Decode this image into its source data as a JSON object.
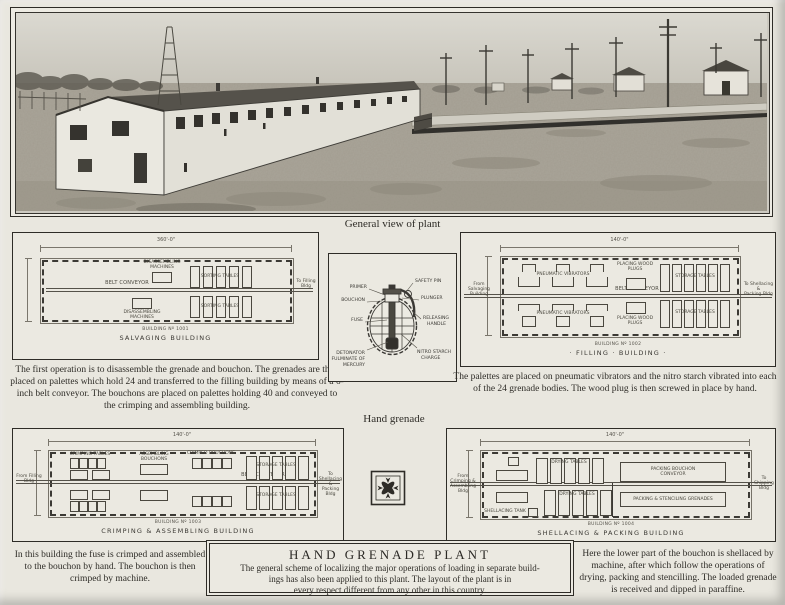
{
  "page": {
    "photo_caption": "General view of plant",
    "hand_grenade_label": "Hand grenade"
  },
  "captions": {
    "salvaging": "The first operation is to disassemble the grenade and bouchon.  The grenades are then placed on palettes which hold 24 and transferred to the filling building by means of a 6-inch belt conveyor.  The bouchons are placed on palettes holding 40 and conveyed to the crimping and assembling building.",
    "filling": "The palettes are placed on pneumatic vibrators and the nitro starch vibrated into each of the 24 grenade bodies.  The wood plug is then screwed in place by hand.",
    "crimping": "In this building the fuse is crimped and assembled to the bouchon by hand.  The bouchon is then crimped by machine.",
    "shellacing": "Here the lower part of the bouchon is shellaced by machine, after which follow the operations of drying, packing and stencilling.  The loaded grenade is received and dipped in paraffine."
  },
  "title_box": {
    "title": "HAND GRENADE PLANT",
    "line1": "The general scheme of localizing the major operations of loading in separate build-",
    "line2": "ings has also been applied to this plant.  The layout of the plant is in",
    "line3": "every respect different from any other in this country."
  },
  "grenade": {
    "primer": "PRIMER",
    "safety_pin": "SAFETY PIN",
    "bouchon": "BOUCHON",
    "plunger": "PLUNGER",
    "fuse": "FUSE",
    "releasing_l1": "RELEASING",
    "releasing_l2": "HANDLE",
    "detonator_l1": "DETONATOR",
    "detonator_l2": "FULMINATE OF",
    "detonator_l3": "MERCURY",
    "nitro_l1": "NITRO STARCH",
    "nitro_l2": "CHARGE"
  },
  "plans": {
    "salvaging": {
      "number": "BUILDING Nº 1001",
      "name": "SALVAGING BUILDING",
      "dim": "360'-0\"",
      "belt": "BELT CONVEYOR",
      "to_label": "To Filling Bldg",
      "machines_l1": "DISASSEMBLING",
      "machines_l2": "MACHINES",
      "tables": "SORTING TABLES"
    },
    "filling": {
      "number": "BUILDING Nº 1002",
      "name": "· FILLING · BUILDING ·",
      "dim": "140'-0\"",
      "belt": "BELT CONVEYOR",
      "from_l1": "From Salvaging",
      "from_l2": "Building",
      "to_l1": "To Shellacing &",
      "to_l2": "Packing Bldg",
      "vibrators": "PNEUMATIC VIBRATORS",
      "plugs_l1": "PLACING WOOD",
      "plugs_l2": "PLUGS",
      "storage": "STORAGE TABLES"
    },
    "crimping": {
      "number": "BUILDING Nº 1003",
      "name": "CRIMPING & ASSEMBLING BUILDING",
      "dim": "140'-0\"",
      "belt": "BELT CONVEYOR",
      "from_label": "From Filling Bldg",
      "to_l1": "To Shellacing &",
      "to_l2": "Packing Bldg",
      "crimping_tables": "CRIMPING TABLES",
      "assembling_l1": "ASSEMBLING",
      "assembling_l2": "BOUCHONS",
      "crimped": "CRIMPED BOUCHONS",
      "storage": "STORAGE TABLES"
    },
    "shellacing": {
      "number": "BUILDING Nº 1004",
      "name": "SHELLACING & PACKING BUILDING",
      "dim": "140'-0\"",
      "from_l1": "From Crimping &",
      "from_l2": "Assembling Bldg",
      "to_label": "To Shipping Bldg",
      "drying": "DRYING TABLES",
      "packing_bouchon_l1": "PACKING BOUCHON",
      "packing_bouchon_l2": "CONVEYOR",
      "packing_grenades": "PACKING & STENCILING GRENADES",
      "tank": "SHELLACING TANK"
    }
  }
}
